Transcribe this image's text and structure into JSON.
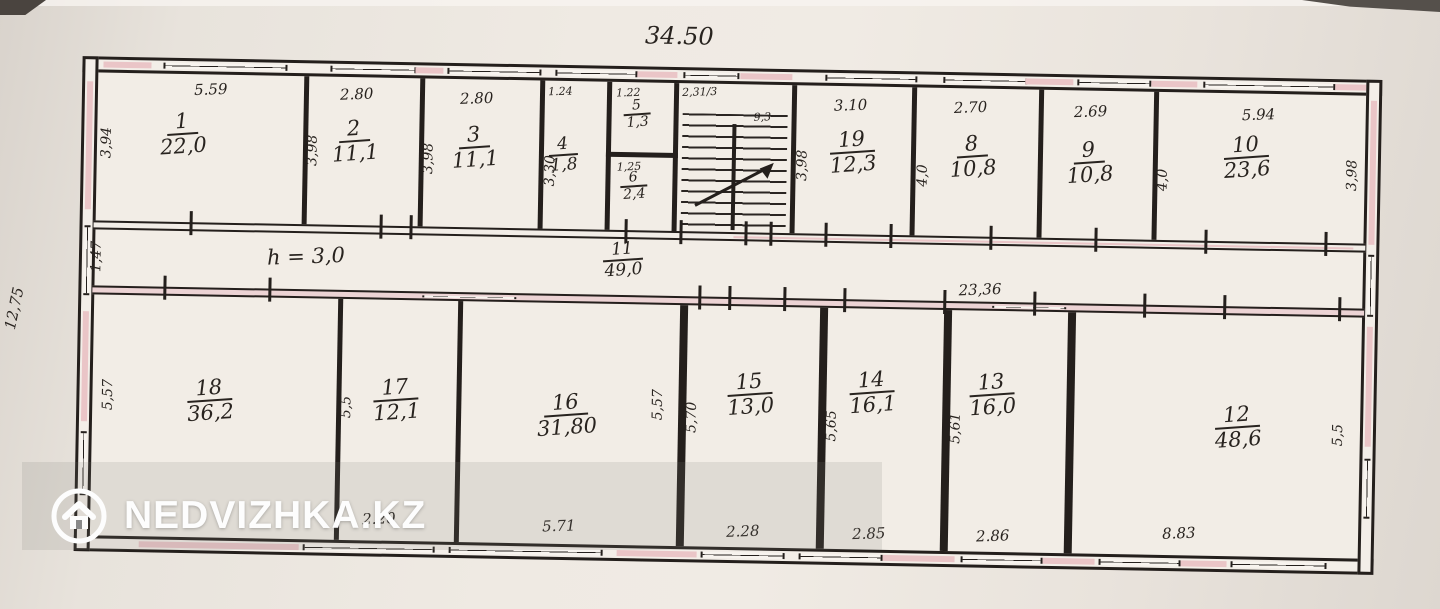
{
  "watermark": {
    "text": "NEDVIZHKA.KZ"
  },
  "plan": {
    "overall_width": "34.50",
    "overall_height": "12,75",
    "top_rooms": [
      {
        "number": "1",
        "area": "22,0",
        "width": "5.59",
        "side": "3,94"
      },
      {
        "number": "2",
        "area": "11,1",
        "width": "2.80",
        "side": "3,98"
      },
      {
        "number": "3",
        "area": "11,1",
        "width": "2.80",
        "side": "3,98"
      },
      {
        "number": "4",
        "area": "1,8",
        "width": "1.24",
        "side": "3,30"
      },
      {
        "number": "5",
        "area": "1,3",
        "width": "1.22"
      },
      {
        "number": "6",
        "area": "2,4",
        "width": "1,25"
      },
      {
        "number": "19",
        "area": "12,3",
        "width": "3.10",
        "side": "3,98"
      },
      {
        "number": "8",
        "area": "10,8",
        "width": "2.70",
        "side": "4,0"
      },
      {
        "number": "9",
        "area": "10,8",
        "width": "2.69",
        "side": "4,0"
      },
      {
        "number": "10",
        "area": "23,6",
        "width": "5.94",
        "side": "3,98"
      }
    ],
    "stairwell": {
      "width_note": "2,31/3",
      "area_note": "9,3"
    },
    "corridor": {
      "number": "11",
      "area": "49,0",
      "height_note": "h = 3,0",
      "left_dim": "1,47",
      "right_dim": "23,36"
    },
    "bottom_rooms": [
      {
        "number": "18",
        "area": "36,2",
        "side": "5,57"
      },
      {
        "number": "17",
        "area": "12,1",
        "width": "2.20",
        "side": "5,5"
      },
      {
        "number": "16",
        "area": "31,80",
        "width": "5.71",
        "side": "5,57"
      },
      {
        "number": "15",
        "area": "13,0",
        "width": "2.28",
        "side": "5,70"
      },
      {
        "number": "14",
        "area": "16,1",
        "width": "2.85",
        "side": "5,65"
      },
      {
        "number": "13",
        "area": "16,0",
        "width": "2.86",
        "side": "5,61"
      },
      {
        "number": "12",
        "area": "48,6",
        "width": "8.83",
        "side": "5,5"
      }
    ]
  }
}
